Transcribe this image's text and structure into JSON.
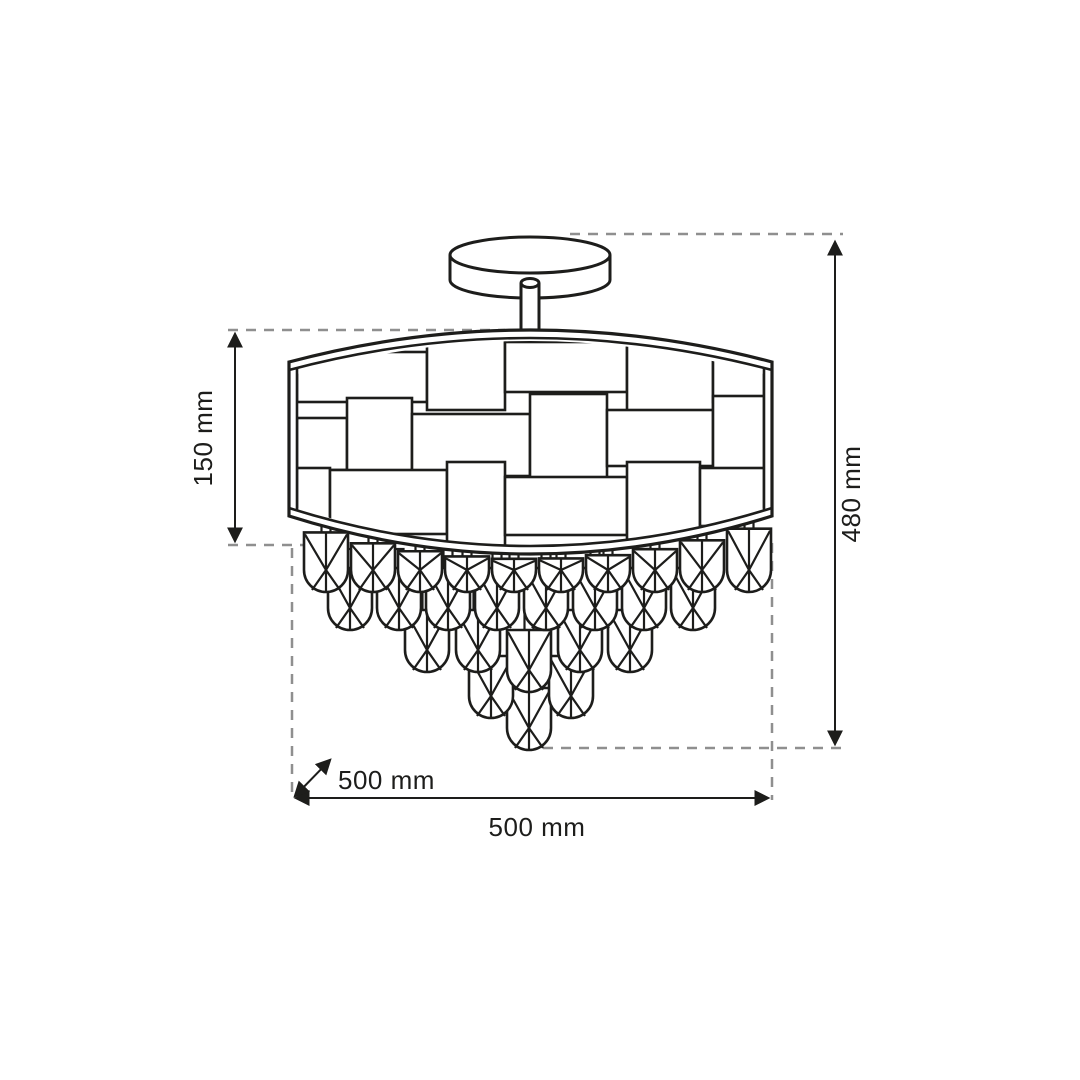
{
  "diagram": {
    "type": "product-dimension-drawing",
    "subject": "ceiling chandelier with woven drum shade and cascading crystal drops",
    "labels": {
      "shade_height": "150 mm",
      "total_height": "480 mm",
      "depth": "500 mm",
      "width": "500 mm"
    },
    "colors": {
      "line": "#1d1d1b",
      "extension_dash": "#8f8f8f",
      "background": "#ffffff"
    }
  }
}
